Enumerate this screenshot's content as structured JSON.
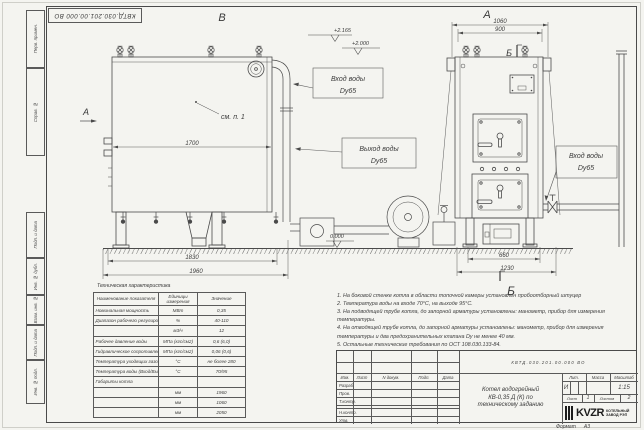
{
  "doc": {
    "number": "КВТД.030.201.00.000 ВО",
    "format_label": "Формат",
    "format_value": "А3"
  },
  "margin_stamp": {
    "cells": [
      "Перв. примен.",
      "Справ. №",
      "Подп. и дата",
      "Инв. № дубл.",
      "Взам. инв. №",
      "Подп. и дата",
      "Инв. № подл."
    ]
  },
  "view_labels": {
    "side": "В",
    "front": "А",
    "section_a": "А",
    "section_b": "Б",
    "view_b": "Б"
  },
  "callouts": {
    "see_detail": "см. п. 1",
    "inlet_top": {
      "line1": "Вход воды",
      "line2": "Dy65"
    },
    "outlet": {
      "line1": "Выход воды",
      "line2": "Dy65"
    },
    "inlet_right": {
      "line1": "Вход воды",
      "line2": "Dy65"
    }
  },
  "elevations": {
    "top": "+2.165",
    "inlet": "+2.000",
    "ground": "0.000"
  },
  "dimensions": {
    "side_width": "1700",
    "side_base": "1830",
    "side_total": "1960",
    "front_width": "1060",
    "front_top": "900",
    "front_base": "660",
    "front_total": "1230"
  },
  "tech_table": {
    "title": "Техническая характеристика",
    "headers": [
      "Наименование показателя",
      "Единицы измерения",
      "Значение"
    ],
    "rows": [
      [
        "Номинальная мощность",
        "МВт",
        "0,35"
      ],
      [
        "Диапазон рабочего регулирования",
        "%",
        "40-110"
      ],
      [
        "",
        "м3/ч",
        "12"
      ],
      [
        "Рабочее давление воды",
        "МПа (кгс/см2)",
        "0,6 (6,0)"
      ],
      [
        "Гидравлическое сопротивление котла",
        "МПа (кгс/см2)",
        "0,06 (0,6)"
      ],
      [
        "Температура уходящих газов",
        "°С",
        "не более 280"
      ],
      [
        "Температура воды (Вход/Выход)",
        "°С",
        "70/95"
      ],
      [
        "Габариты котла",
        "",
        ""
      ],
      [
        "",
        "мм",
        "1960"
      ],
      [
        "",
        "мм",
        "1060"
      ],
      [
        "",
        "мм",
        "2050"
      ]
    ]
  },
  "notes": [
    "1. На боковой стенке котла в области топочной камеры установлен пробоотборный штуцер",
    "2. Температура воды на входе 70°С, на выходе 95°С.",
    "3. На подводящей трубе котла, до запорной арматуры установлены: манометр, прибор для измерения температуры.",
    "4. На отводящей трубе котла, до запорной арматуры установлены: манометр, прибор для измерения температуры и два предохранительных клапана Dy не менее 40 мм.",
    "5. Остальные технические требования по ОСТ 108.030.133-84."
  ],
  "title_block": {
    "header_cols": [
      "Изм.",
      "Лист",
      "N докум.",
      "Подп.",
      "Дата"
    ],
    "sign_rows": [
      "Разраб.",
      "Пров.",
      "Т.контр.",
      "Н.контр.",
      "Утв."
    ],
    "product_lines": [
      "Котел водогрейный",
      "КВ-0,35 Д (К) по",
      "техническому заданию"
    ],
    "lit_label": "Лит.",
    "mass_label": "Масса",
    "scale_label": "Масштаб",
    "lit_value": "И",
    "scale_value": "1:15",
    "sheet_label": "Лист",
    "sheet_value": "1",
    "sheets_label": "Листов",
    "sheets_value": "2",
    "logo_text": "KVZR",
    "logo_caption_line1": "КОТЕЛЬНЫЙ",
    "logo_caption_line2": "ЗАВОД РЭП"
  }
}
